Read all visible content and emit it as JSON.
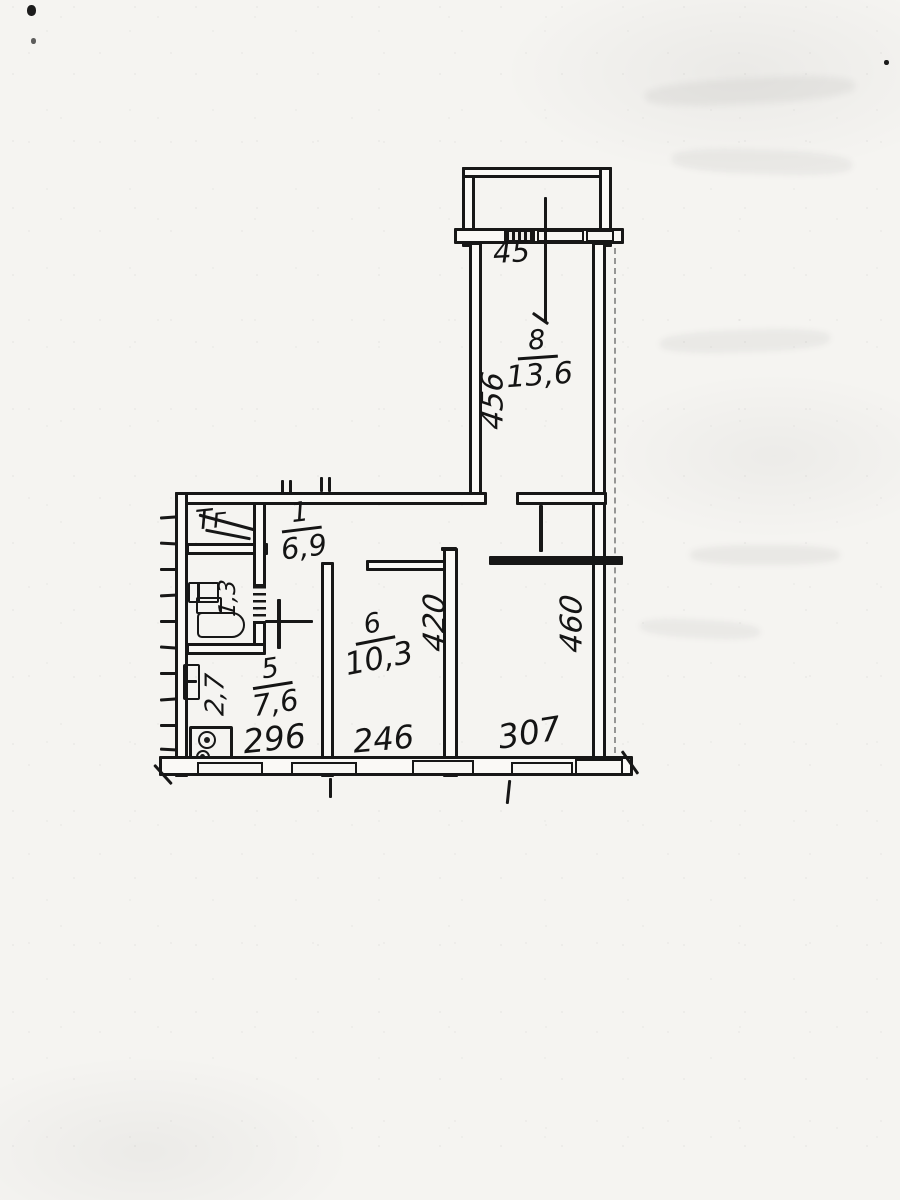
{
  "document": {
    "type": "hand-drawn apartment floor plan (scanned technical passport sheet)"
  },
  "labels": {
    "closet": "Тг",
    "corridor_number": "1",
    "corridor_area": "6,9",
    "wc_area": "1,3",
    "kitchen_number": "5",
    "kitchen_area": "7,6",
    "kitchen_side_dim": "2,7",
    "kitchen_width": "296",
    "room6_number": "6",
    "room6_area": "10,3",
    "room6_height": "420",
    "room6_width": "246",
    "room8_number": "8",
    "room8_area": "13,6",
    "room8_height": "456",
    "balcony_dim": "45",
    "living_width": "307",
    "living_height": "460"
  }
}
